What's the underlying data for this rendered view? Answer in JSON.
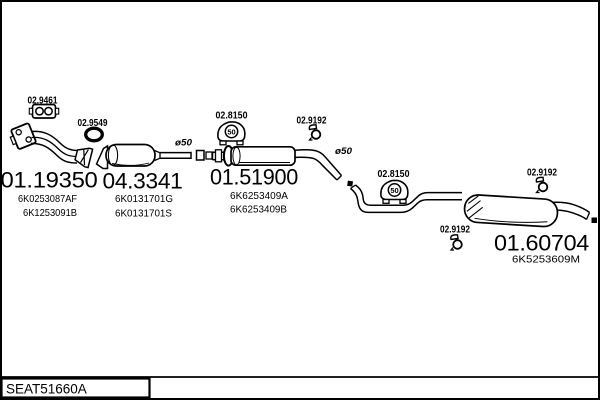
{
  "footer": {
    "drawing_code": "SEAT51660A"
  },
  "colors": {
    "ink": "#000000",
    "background": "#ffffff"
  },
  "parts": {
    "front_pipe": {
      "code": "01.19350",
      "refs": [
        "6K0253087AF",
        "6K1253091B"
      ]
    },
    "catalyst": {
      "code": "04.3341",
      "refs": [
        "6K0131701G",
        "6K0131701S"
      ]
    },
    "centre_muffler": {
      "code": "01.51900",
      "refs": [
        "6K6253409A",
        "6K6253409B"
      ]
    },
    "rear_muffler": {
      "code": "01.60704",
      "refs": [
        "6K5253609M"
      ]
    }
  },
  "fittings": {
    "flange_gasket_code": "02.9461",
    "ring_gasket_code": "02.9549",
    "rubber_mount_code": "02.8150",
    "clamp_code": "02.9192"
  },
  "annotations": {
    "pipe_diameter": "ø50",
    "mount_marking": "50"
  }
}
